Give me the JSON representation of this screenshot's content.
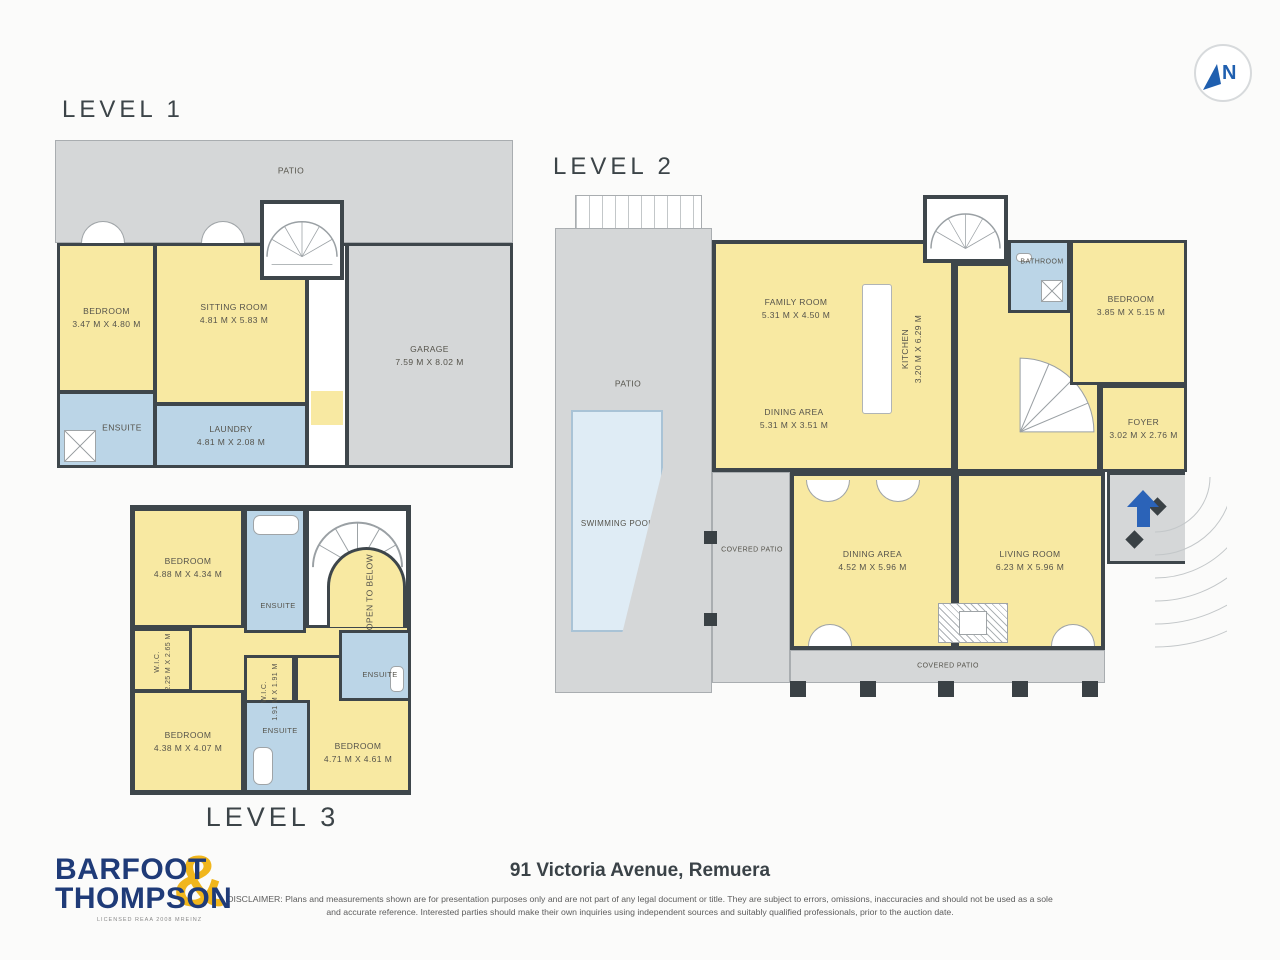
{
  "page": {
    "address_title": "91 Victoria Avenue, Remuera"
  },
  "north_arrow": {
    "label": "N"
  },
  "levels": {
    "level1": {
      "label": "LEVEL 1",
      "rooms": {
        "patio": {
          "name": "PATIO"
        },
        "bedroom": {
          "name": "BEDROOM",
          "dims": "3.47 M X 4.80 M"
        },
        "sitting_room": {
          "name": "SITTING ROOM",
          "dims": "4.81 M X 5.83 M"
        },
        "garage": {
          "name": "GARAGE",
          "dims": "7.59 M X 8.02 M"
        },
        "ensuite": {
          "name": "ENSUITE"
        },
        "laundry": {
          "name": "LAUNDRY",
          "dims": "4.81 M X 2.08 M"
        }
      }
    },
    "level2": {
      "label": "LEVEL 2",
      "rooms": {
        "patio": {
          "name": "PATIO"
        },
        "swimming_pool": {
          "name": "SWIMMING POOL"
        },
        "family_room": {
          "name": "FAMILY ROOM",
          "dims": "5.31 M X 4.50 M"
        },
        "dining_area_upper": {
          "name": "DINING AREA",
          "dims": "5.31 M X 3.51 M"
        },
        "kitchen": {
          "name": "KITCHEN",
          "dims": "3.20 M X 6.29 M"
        },
        "bathroom": {
          "name": "BATHROOM"
        },
        "bedroom": {
          "name": "BEDROOM",
          "dims": "3.85 M X 5.15 M"
        },
        "foyer": {
          "name": "FOYER",
          "dims": "3.02 M X 2.76 M"
        },
        "covered_patio_left": {
          "name": "COVERED PATIO"
        },
        "dining_area_lower": {
          "name": "DINING AREA",
          "dims": "4.52 M X 5.96 M"
        },
        "living_room": {
          "name": "LIVING ROOM",
          "dims": "6.23 M X 5.96 M"
        },
        "covered_patio_bottom": {
          "name": "COVERED PATIO"
        }
      }
    },
    "level3": {
      "label": "LEVEL 3",
      "rooms": {
        "bedroom_top": {
          "name": "BEDROOM",
          "dims": "4.88 M X 4.34 M"
        },
        "ensuite_top": {
          "name": "ENSUITE"
        },
        "open_to_below": {
          "name": "OPEN TO BELOW"
        },
        "wic_left": {
          "name": "W.I.C.",
          "dims": "2.25 M X 2.65 M"
        },
        "wic_center": {
          "name": "W.I.C.",
          "dims": "1.91 M X 1.91 M"
        },
        "ensuite_right": {
          "name": "ENSUITE"
        },
        "bedroom_left": {
          "name": "BEDROOM",
          "dims": "4.38 M X 4.07 M"
        },
        "ensuite_bottom": {
          "name": "ENSUITE"
        },
        "bedroom_right": {
          "name": "BEDROOM",
          "dims": "4.71 M X 4.61 M"
        }
      }
    }
  },
  "footer": {
    "logo_line1": "BARFOOT",
    "logo_line2": "THOMPSON",
    "logo_amp": "&",
    "logo_tagline": "LICENSED REAA 2008 MREINZ",
    "disclaimer_line1": "DISCLAIMER: Plans and measurements shown are for presentation purposes only and are not part of any legal document or title. They are subject to errors, omissions, inaccuracies and should not be used",
    "disclaimer_line2": "as a sole and accurate reference. Interested parties should make their own inquiries using independent sources and suitably qualified professionals, prior to the auction date."
  },
  "colors": {
    "wall": "#3E464B",
    "room_yellow": "#F8E9A2",
    "wet_area_blue": "#BBD5E7",
    "patio_gray": "#D5D7D8",
    "pool_blue": "#DFECF5",
    "entry_arrow_blue": "#2B63B8",
    "brand_navy": "#1F3B78",
    "brand_gold": "#F1B61C"
  }
}
